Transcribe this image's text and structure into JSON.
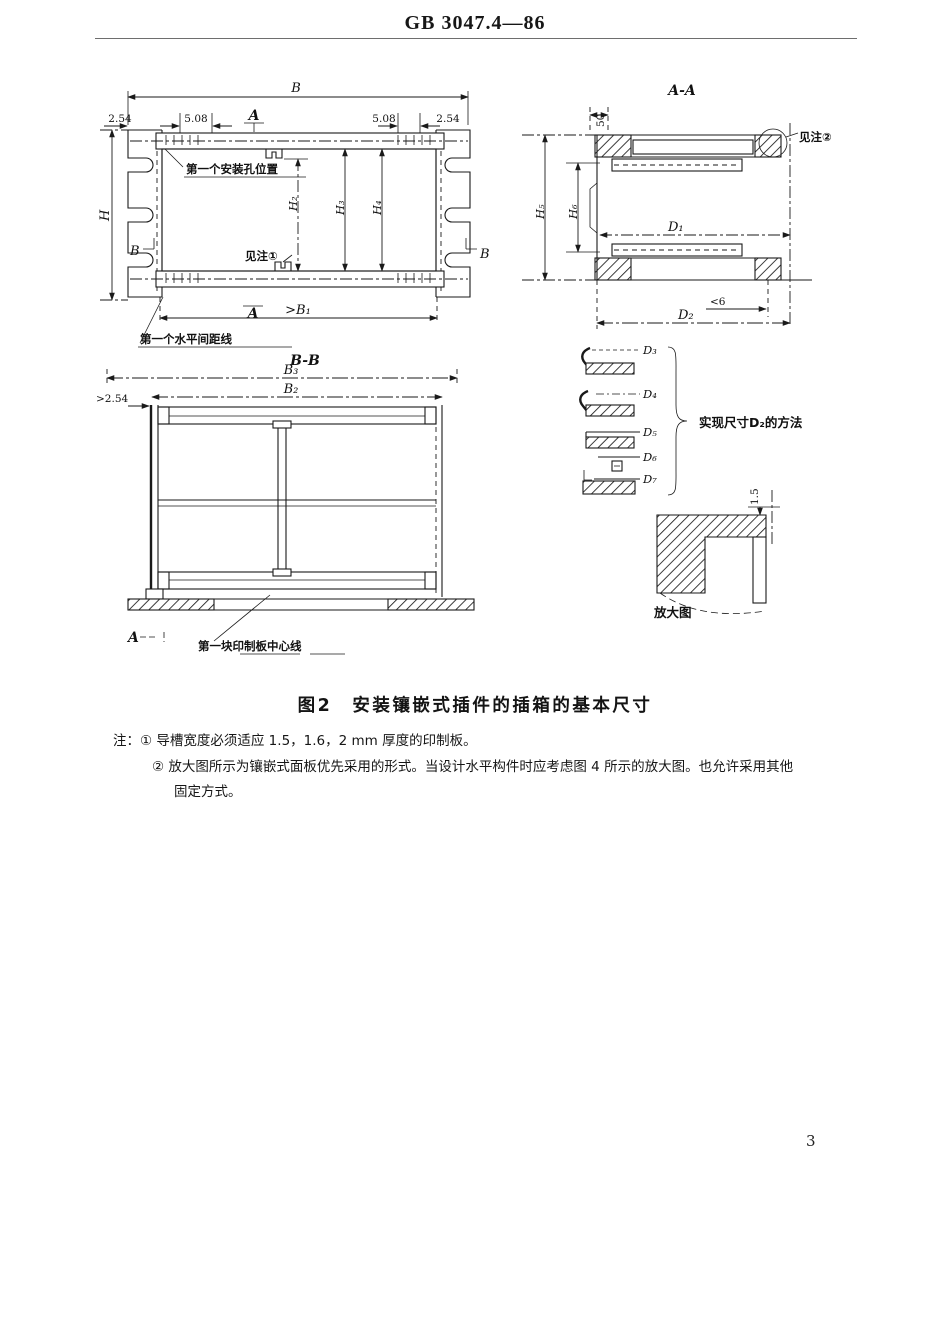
{
  "page": {
    "header": "GB 3047.4—86",
    "page_number": "3"
  },
  "figure": {
    "caption": "图2　安装镶嵌式插件的插箱的基本尺寸",
    "front_view": {
      "dim_B": "B",
      "dim_254_left": "2.54",
      "dim_508_left": "5.08",
      "dim_508_right": "5.08",
      "dim_254_right": "2.54",
      "dim_H": "H",
      "dim_H2": "H₂",
      "dim_H3": "H₃",
      "dim_H4": "H₄",
      "dim_B1": ">B₁",
      "marker_A_top": "A",
      "marker_A_bottom": "A",
      "marker_B_left": "B",
      "marker_B_right": "B",
      "label_first_hole": "第一个安装孔位置",
      "label_see_note1": "见注①",
      "label_first_pitch": "第一个水平间距线"
    },
    "section_AA": {
      "title": "A-A",
      "dim_50": "50",
      "dim_H5": "H₅",
      "dim_H6": "H₆",
      "dim_D1": "D₁",
      "dim_lt6": "<6",
      "dim_D2": "D₂",
      "label_see_note2": "见注②"
    },
    "d2_methods": {
      "dims": [
        "D₃",
        "D₄",
        "D₅",
        "D₆",
        "D₇"
      ],
      "label": "实现尺寸D₂的方法"
    },
    "enlarged": {
      "dim_15": "1.5",
      "label": "放大图"
    },
    "section_BB": {
      "title": "B-B",
      "dim_B3": "B₃",
      "dim_B2": "B₂",
      "dim_254": ">2.54",
      "marker_A": "A",
      "label_board_centerline": "第一块印制板中心线"
    },
    "notes": {
      "line1": "注：① 导槽宽度必须适应 1.5，1.6，2 mm 厚度的印制板。",
      "line2": "② 放大图所示为镶嵌式面板优先采用的形式。当设计水平构件时应考虑图 4 所示的放大图。也允许采用其他",
      "line3": "固定方式。"
    }
  }
}
